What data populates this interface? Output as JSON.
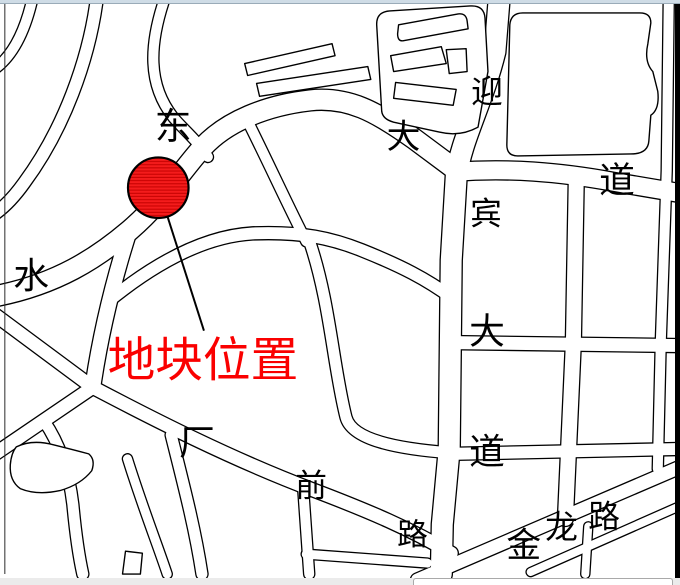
{
  "frame": {
    "top_strip_color": "#cfdce6",
    "right_bar_color": "#000000",
    "bottom_strip_color": "#ebebeb",
    "bottom_panel_color": "#ffffff"
  },
  "map": {
    "background_color": "#ffffff",
    "road_outline_color": "#000000",
    "road_fill_color": "#ffffff",
    "marker": {
      "shape": "hatched-circle",
      "fill_color": "#f41c1c",
      "hatch_color": "#c40000",
      "outline_color": "#000000",
      "cx": 157,
      "cy": 189,
      "r": 30.5,
      "leader_line": {
        "x1": 158,
        "y1": 192,
        "x2": 203,
        "y2": 333,
        "color": "#000000",
        "width": 2
      },
      "label": {
        "text": "地块位置",
        "color": "#fa0000",
        "x": 106,
        "y": 379,
        "font_size": 48
      }
    },
    "street_labels": [
      {
        "text": "东",
        "x": 172,
        "y": 140,
        "size": 37
      },
      {
        "text": "水",
        "x": 29,
        "y": 290,
        "size": 36
      },
      {
        "text": "大",
        "x": 404,
        "y": 149,
        "size": 34
      },
      {
        "text": "道",
        "x": 619,
        "y": 194,
        "size": 36
      },
      {
        "text": "迎",
        "x": 488,
        "y": 103,
        "size": 32
      },
      {
        "text": "宾",
        "x": 487,
        "y": 226,
        "size": 32
      },
      {
        "text": "大",
        "x": 488,
        "y": 346,
        "size": 36
      },
      {
        "text": "道",
        "x": 488,
        "y": 467,
        "size": 36
      },
      {
        "text": "厂",
        "x": 196,
        "y": 458,
        "size": 36
      },
      {
        "text": "前",
        "x": 311,
        "y": 500,
        "size": 32
      },
      {
        "text": "路",
        "x": 413,
        "y": 549,
        "size": 31
      },
      {
        "text": "金",
        "x": 525,
        "y": 561,
        "size": 35
      },
      {
        "text": "龙",
        "x": 563,
        "y": 542,
        "size": 33
      },
      {
        "text": "路",
        "x": 606,
        "y": 531,
        "size": 32
      }
    ],
    "label_color": "#000000"
  }
}
